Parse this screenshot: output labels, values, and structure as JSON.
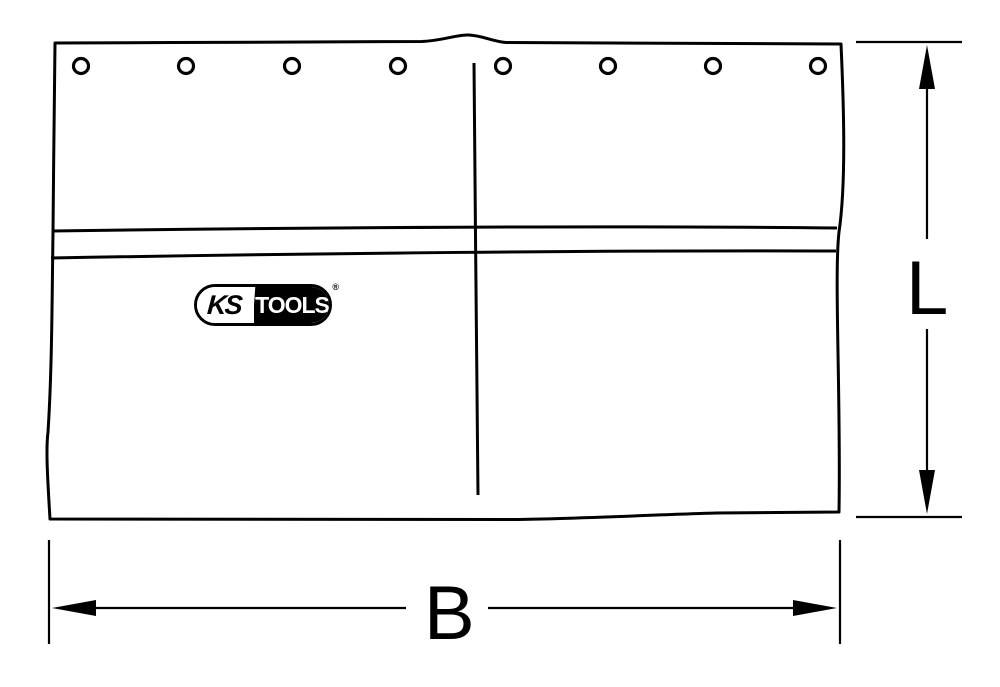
{
  "page": {
    "background_color": "#ffffff",
    "line_color": "#000000"
  },
  "drawing": {
    "eyelet_count": 8,
    "eyelet_icon": "grommet-circle"
  },
  "labels": {
    "height_dimension": "L",
    "width_dimension": "B"
  },
  "logo": {
    "ks": "KS",
    "tools": "TOOLS",
    "registered_mark": "®"
  }
}
